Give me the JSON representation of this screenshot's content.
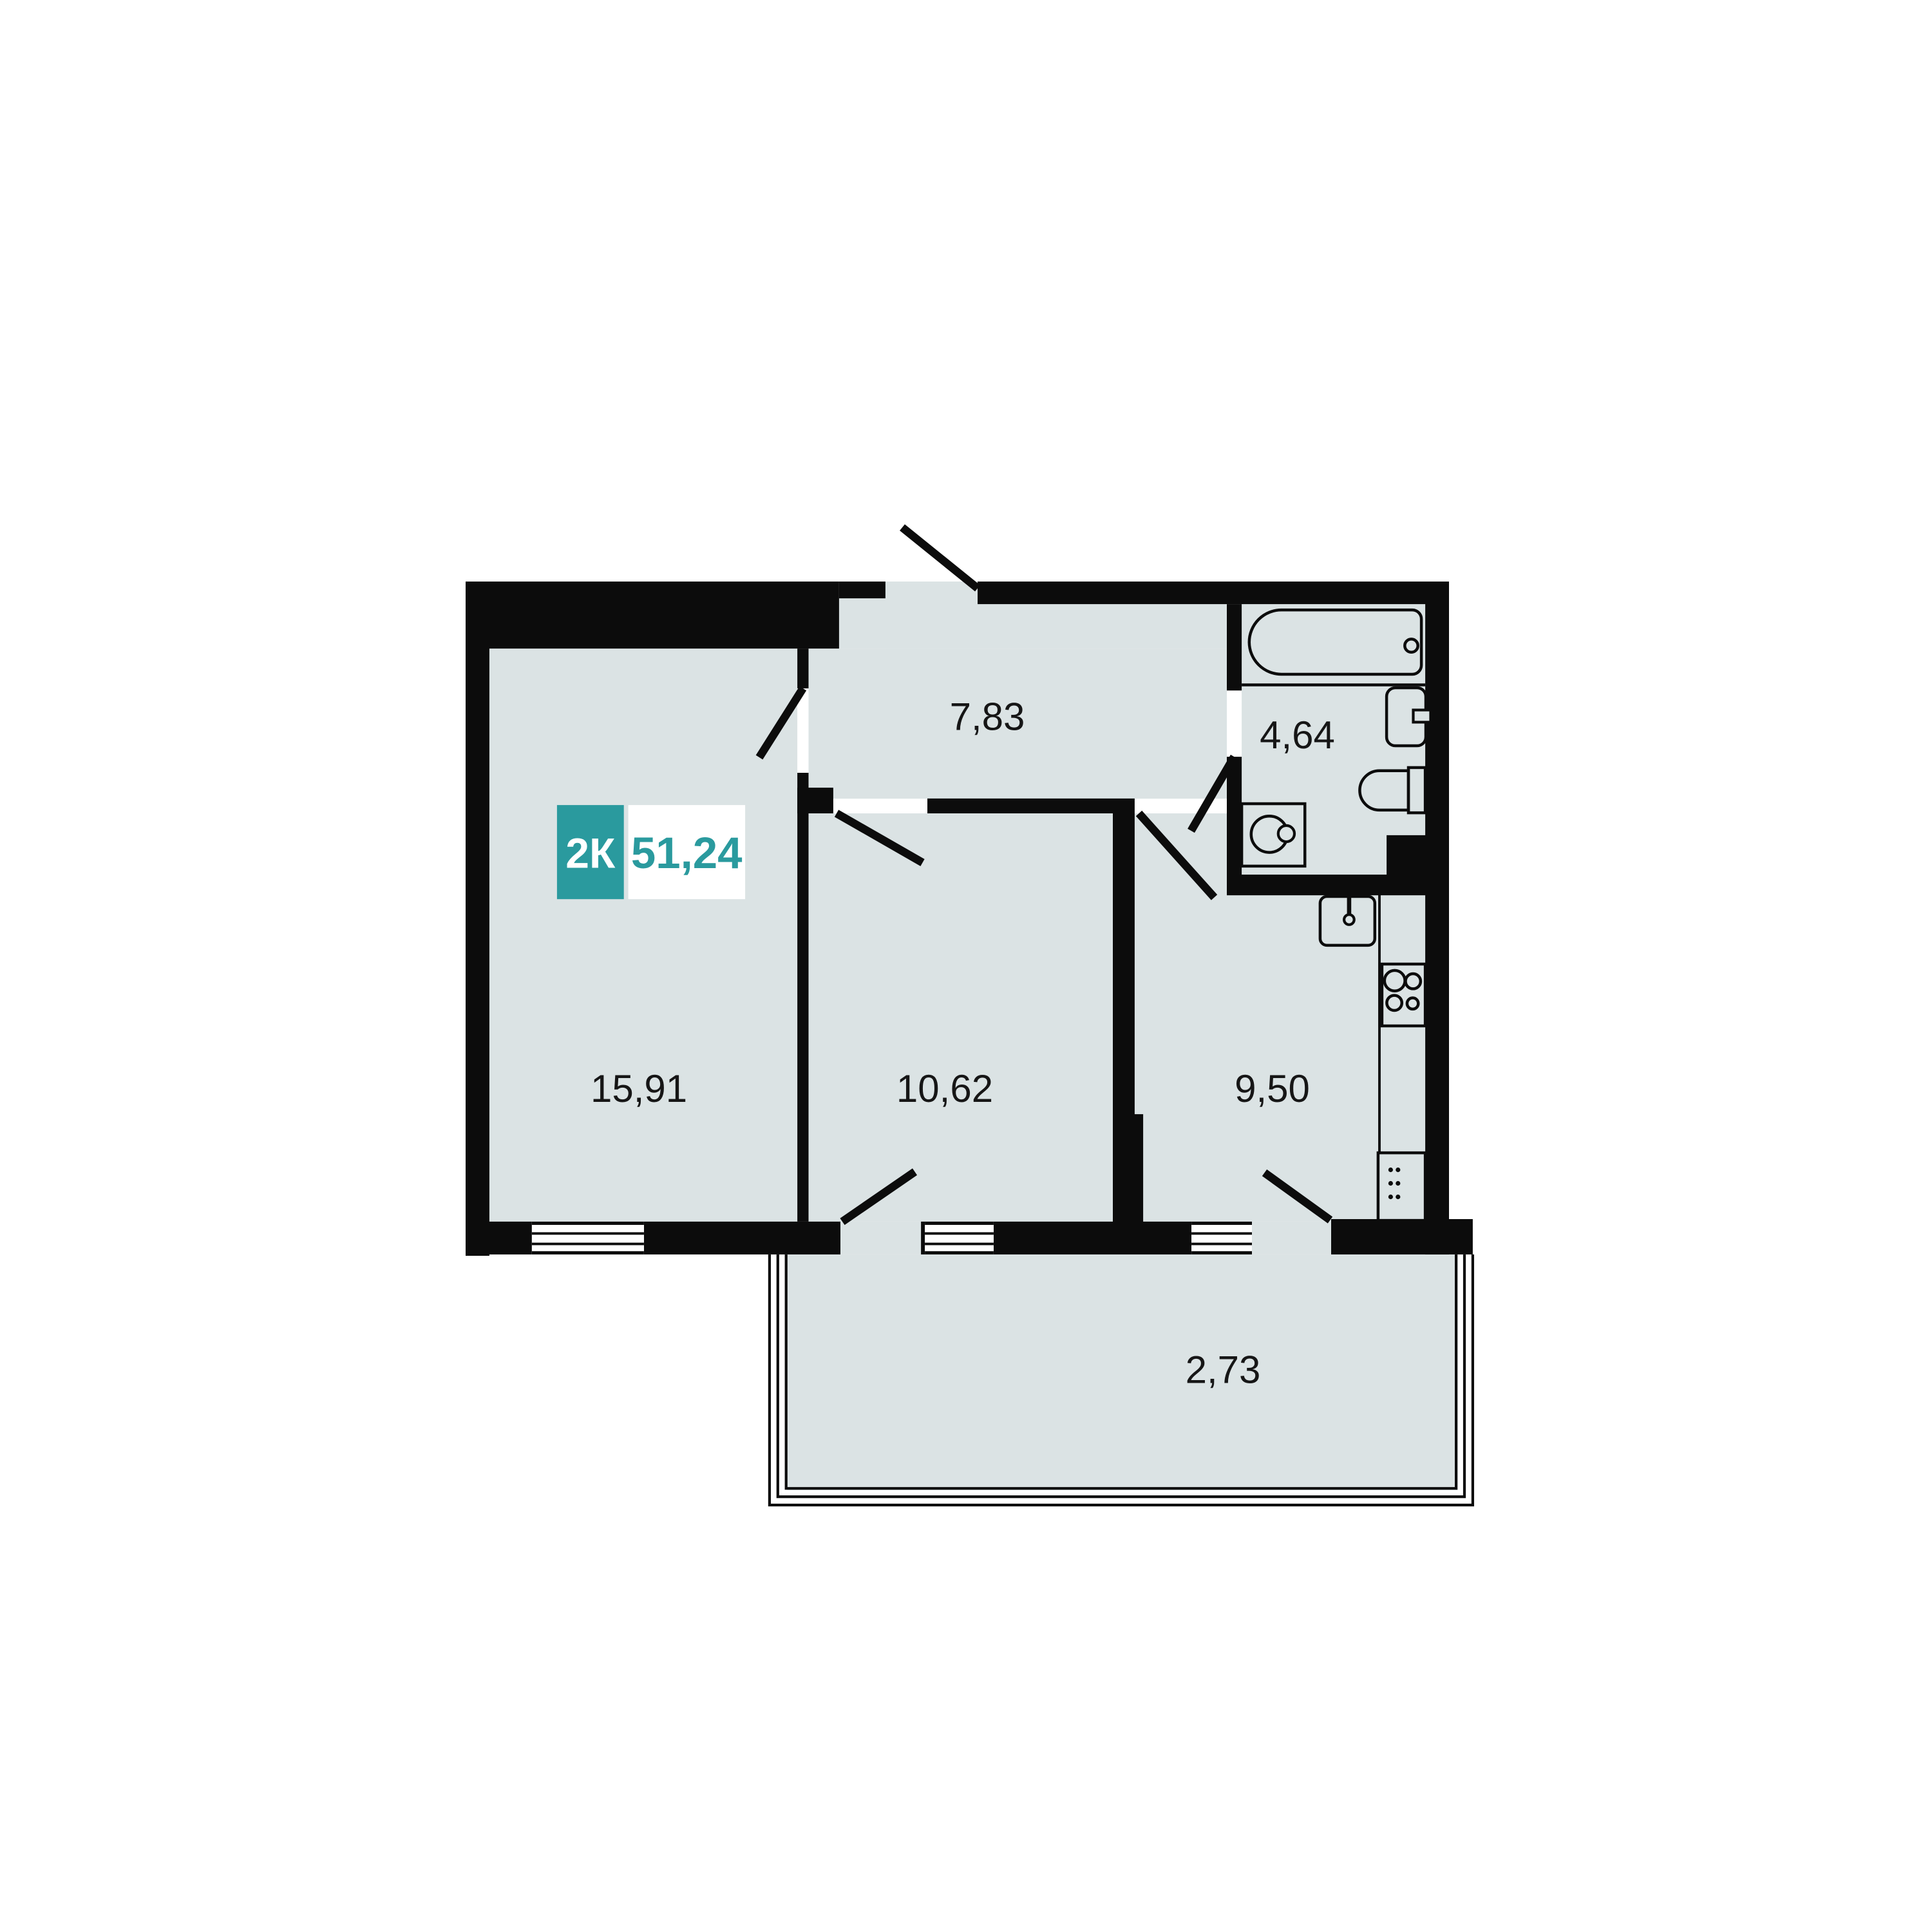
{
  "plan": {
    "badge": {
      "type": "2К",
      "area": "51,24"
    },
    "rooms": [
      {
        "name": "living-room",
        "area": "15,91"
      },
      {
        "name": "bedroom",
        "area": "10,62"
      },
      {
        "name": "kitchen",
        "area": "9,50"
      },
      {
        "name": "hallway",
        "area": "7,83"
      },
      {
        "name": "bathroom",
        "area": "4,64"
      },
      {
        "name": "balcony",
        "area": "2,73"
      }
    ],
    "colors": {
      "accent": "#2a9a9e",
      "wall": "#0c0c0c",
      "floor": "#dbe3e4",
      "background": "#ffffff"
    },
    "fixtures": [
      "bathtub-icon",
      "bath-sink-icon",
      "toilet-icon",
      "washing-machine-icon",
      "kitchen-sink-icon",
      "stove-icon",
      "kitchen-counter",
      "fridge-icon",
      "entrance-door",
      "room-doors",
      "balcony-doors",
      "windows"
    ]
  }
}
